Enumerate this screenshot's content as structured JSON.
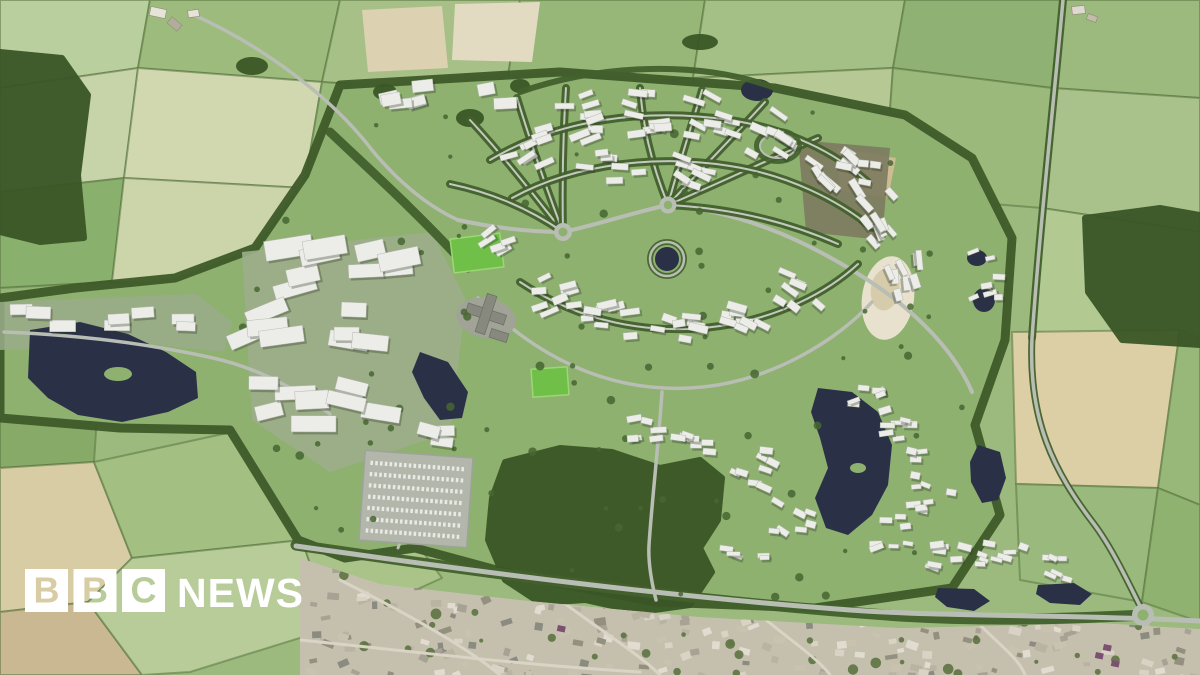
{
  "image": {
    "kind": "news-photo",
    "description": "CGI aerial masterplan visualisation of a proposed new settlement with white model buildings, tree-lined streets, lakes and woodland set among farmland, above an existing town"
  },
  "logo": {
    "blocks": [
      "B",
      "B",
      "C"
    ],
    "wordmark": "NEWS",
    "block_color": "#ffffff",
    "wordmark_color": "#ffffff"
  },
  "colors": {
    "fieldBase": "#9cba7e",
    "hedge": "#5a7440",
    "siteGrass": "#8eb170",
    "siteEdge": "#3d5a28",
    "wood": "#3a5626",
    "treeBelt": "#42602c",
    "water": "#2a3147",
    "road": "#b9beb4",
    "roadMinor": "#c4c9be",
    "building": "#ecede9",
    "buildingStroke": "#b4b7ae",
    "buildingShadow": "rgba(43,53,33,0.32)",
    "pitch": "#6fbf49",
    "townBase": "#c5c0ae",
    "terrace": "#d4e3bc",
    "scatterTree": "#466631"
  },
  "scene": {
    "fields": [
      {
        "pts": "0,0 150,0 138,68 0,88",
        "fill": "#b9cf9e"
      },
      {
        "pts": "150,0 340,0 322,82 138,68",
        "fill": "#9cbb7d"
      },
      {
        "pts": "340,0 520,0 505,95 322,82",
        "fill": "#a6c087"
      },
      {
        "pts": "520,0 705,0 693,78 505,95",
        "fill": "#97b778"
      },
      {
        "pts": "705,0 905,0 893,68 693,78",
        "fill": "#a4c086"
      },
      {
        "pts": "905,0 1062,0 1052,88 893,68",
        "fill": "#8fb173"
      },
      {
        "pts": "1062,0 1200,0 1200,98 1052,88",
        "fill": "#9cba7e"
      },
      {
        "pts": "0,88 138,68 124,178 0,192",
        "fill": "#c7d4a9"
      },
      {
        "pts": "138,68 322,82 304,188 124,178",
        "fill": "#d1d8b0"
      },
      {
        "pts": "0,192 124,178 112,282 0,288",
        "fill": "#8ab06d"
      },
      {
        "pts": "124,178 304,188 292,285 112,282",
        "fill": "#cbd5a9"
      },
      {
        "pts": "322,82 505,95 470,200 304,188",
        "fill": "#9aba7c"
      },
      {
        "pts": "693,78 893,68 884,195 705,188",
        "fill": "#b6c994"
      },
      {
        "pts": "893,68 1052,88 1042,208 884,195",
        "fill": "#9ab97b"
      },
      {
        "pts": "1052,88 1200,98 1200,232 1042,208",
        "fill": "#a9c28b"
      },
      {
        "pts": "1042,208 1200,232 1200,338 1032,332",
        "fill": "#b2c992"
      },
      {
        "pts": "0,288 112,282 102,342 0,345",
        "fill": "#94b577"
      },
      {
        "pts": "0,345 102,342 94,462 0,468",
        "fill": "#88aa69"
      },
      {
        "pts": "0,468 94,462 132,558 88,602 0,612",
        "fill": "#d7cca4"
      },
      {
        "pts": "0,612 88,602 142,675 0,675",
        "fill": "#c9b892"
      },
      {
        "pts": "94,462 232,432 302,540 132,558",
        "fill": "#a3bf82"
      },
      {
        "pts": "132,558 302,540 332,628 190,672 142,675 88,602",
        "fill": "#b7cc99"
      },
      {
        "pts": "1012,332 1180,330 1158,488 1016,484",
        "fill": "#dccfa5"
      },
      {
        "pts": "1180,330 1200,338 1200,505 1158,488",
        "fill": "#98b87a"
      },
      {
        "pts": "1016,484 1158,488 1142,602 1020,580",
        "fill": "#9aba7d"
      },
      {
        "pts": "1158,488 1200,505 1200,622 1142,602",
        "fill": "#8fb271"
      },
      {
        "pts": "302,540 420,548 442,578 332,628",
        "fill": "#aac388"
      },
      {
        "pts": "304,188 470,200 430,260 292,285",
        "fill": "#8fb372"
      }
    ],
    "site": {
      "pts": "340,85 560,72 775,88 905,115 972,158 1012,238 1005,340 975,425 1000,515 952,588 815,608 655,602 515,575 415,548 345,558 298,540 230,430 120,428 0,418 0,298 75,288 175,278 255,248 305,175",
      "fill": "#8eb170",
      "edge": "#3d5a28"
    },
    "platforms": [
      {
        "pts": "242,252 432,232 466,300 450,432 330,472 252,420",
        "fill": "#9dae8b",
        "op": 0.9
      },
      {
        "pts": "0,302 196,294 232,322 224,352 150,344 0,350",
        "fill": "#9aab89",
        "op": 0.85
      },
      {
        "pts": "836,148 896,158 888,198 840,190",
        "fill": "#ccbb93",
        "op": 1
      },
      {
        "pts": "798,140 890,148 882,240 806,232",
        "fill": "#7c7b5f",
        "op": 0.9
      }
    ],
    "terraces": [
      [
        112,
        388,
        14,
        8
      ],
      [
        112,
        388,
        24,
        13
      ],
      [
        112,
        388,
        34,
        18
      ],
      [
        112,
        388,
        44,
        24
      ]
    ],
    "sand_pit": {
      "cx": 888,
      "cy": 298,
      "rx": 26,
      "ry": 42,
      "rot": 8,
      "fill": "#e8e1cd",
      "inner": "#d6cbaa"
    },
    "construction": {
      "pts": "362,10 442,6 448,68 368,72",
      "fill": "#dcd2b2"
    },
    "pale_field": {
      "pts": "455,4 540,2 532,62 452,60",
      "fill": "#e2dbc2"
    },
    "woodlands": [
      {
        "t": "p",
        "pts": "0,52 62,58 88,95 78,175 84,238 40,242 0,232"
      },
      {
        "t": "p",
        "pts": "505,462 560,448 612,452 660,468 700,460 722,478 718,520 700,548 712,572 690,605 640,612 585,600 540,603 505,580 488,540 492,498"
      },
      {
        "t": "p",
        "pts": "1085,218 1160,208 1200,215 1200,345 1122,340 1088,292"
      },
      {
        "t": "e",
        "cx": 252,
        "cy": 66,
        "rx": 16,
        "ry": 9
      },
      {
        "t": "e",
        "cx": 700,
        "cy": 42,
        "rx": 18,
        "ry": 8
      },
      {
        "t": "e",
        "cx": 385,
        "cy": 92,
        "rx": 12,
        "ry": 8
      },
      {
        "t": "e",
        "cx": 470,
        "cy": 118,
        "rx": 14,
        "ry": 9
      },
      {
        "t": "e",
        "cx": 520,
        "cy": 86,
        "rx": 10,
        "ry": 7
      }
    ],
    "streams": [
      {
        "d": "M330,132 C370,170 420,215 468,268",
        "w": 9
      },
      {
        "d": "M1063,0 C1052,120 1040,225 1032,338",
        "w": 8
      },
      {
        "d": "M1032,338 C1028,420 1054,472 1094,524 C1112,548 1128,582 1140,606",
        "w": 7
      },
      {
        "d": "M296,545 C500,575 700,602 900,616 C1000,622 1080,618 1145,615",
        "w": 11
      },
      {
        "d": "M520,92 C600,64 700,60 775,88",
        "w": 6
      }
    ],
    "lakes": [
      {
        "t": "p",
        "pts": "30,330 80,322 128,334 166,352 196,372 198,398 168,412 122,422 78,415 48,398 28,378"
      },
      {
        "t": "e",
        "cx": 118,
        "cy": 374,
        "rx": 14,
        "ry": 7,
        "fill": "#8eb170"
      },
      {
        "t": "p",
        "pts": "420,352 448,362 468,392 462,418 440,420 424,398 412,372"
      },
      {
        "t": "c",
        "cx": 667,
        "cy": 259,
        "r": 12
      },
      {
        "t": "e",
        "cx": 757,
        "cy": 90,
        "rx": 16,
        "ry": 11
      },
      {
        "t": "p",
        "pts": "818,388 852,392 878,412 892,445 888,485 872,515 848,535 826,528 815,498 828,468 820,438 811,412"
      },
      {
        "t": "e",
        "cx": 858,
        "cy": 468,
        "rx": 8,
        "ry": 5,
        "fill": "#8eb170"
      },
      {
        "t": "p",
        "pts": "978,445 1000,452 1006,478 998,500 982,503 971,482 970,462"
      },
      {
        "t": "p",
        "pts": "938,588 974,589 990,601 974,611 947,607 935,597"
      },
      {
        "t": "p",
        "pts": "1038,585 1074,583 1092,594 1080,605 1050,603 1036,594"
      },
      {
        "t": "e",
        "cx": 977,
        "cy": 258,
        "rx": 10,
        "ry": 8
      },
      {
        "t": "e",
        "cx": 984,
        "cy": 300,
        "rx": 11,
        "ry": 12
      }
    ],
    "roads": [
      {
        "d": "M296,546 C480,572 660,596 850,610 C950,617 1060,614 1200,621",
        "w": 5
      },
      {
        "d": "M1143,616 L1170,675",
        "w": 4.5
      },
      {
        "d": "M1063,0 C1052,120 1040,225 1032,338 C1028,420 1054,472 1094,524 C1112,548 1128,582 1140,606",
        "w": 3.5
      },
      {
        "d": "M196,16 C260,45 330,95 372,150 C395,178 425,205 458,220",
        "w": 3.5
      },
      {
        "d": "M458,220 C495,228 530,232 563,232",
        "w": 4
      },
      {
        "d": "M563,232 C600,224 635,212 668,205",
        "w": 4
      },
      {
        "d": "M668,205 C740,212 800,238 855,272 C905,302 952,345 972,392",
        "w": 4
      },
      {
        "d": "M478,298 C540,360 610,392 690,388 C770,384 840,338 872,302",
        "w": 3.5
      },
      {
        "d": "M662,392 C658,450 652,500 649,545 C648,562 651,580 656,600",
        "w": 3.5
      },
      {
        "d": "M440,470 C420,500 406,524 398,548",
        "w": 3
      },
      {
        "d": "M4,332 C80,335 150,344 213,358 C258,368 298,390 330,414",
        "w": 3.5
      }
    ],
    "streets": [
      "M563,232 C530,190 500,152 470,120",
      "M563,232 C545,185 530,140 517,98",
      "M563,232 C562,182 563,135 566,88",
      "M563,232 C525,206 488,192 450,184",
      "M668,205 C650,160 643,125 640,88",
      "M668,205 C680,160 692,125 702,90",
      "M668,205 C705,165 735,135 765,102",
      "M668,205 C722,182 772,158 818,138",
      "M668,205 C730,208 788,222 838,244",
      "M490,160 C560,118 650,108 730,120 C788,129 835,152 868,182",
      "M512,198 C578,162 660,155 730,166 C788,175 838,200 872,228",
      "M520,282 C580,322 650,336 720,326 C778,318 828,292 858,264"
    ],
    "ring_road": {
      "cx": 667,
      "cy": 259,
      "r": 17
    },
    "oval_park": {
      "cx": 778,
      "cy": 146,
      "rx": 18,
      "ry": 12
    },
    "roundabouts": [
      [
        563,
        232,
        9
      ],
      [
        668,
        205,
        8.5
      ],
      [
        1143,
        615,
        11
      ]
    ],
    "pitches": [
      [
        452,
        236,
        50,
        34,
        -7
      ],
      [
        532,
        368,
        36,
        28,
        -4
      ]
    ],
    "campus": {
      "pad": {
        "cx": 486,
        "cy": 318,
        "rx": 30,
        "ry": 20,
        "rot": 10,
        "fill": "#a0a396"
      },
      "rot": "rotate(18 486 314)",
      "rects": [
        [
          466,
          309,
          40,
          10
        ],
        [
          481,
          294,
          10,
          40
        ],
        [
          496,
          326,
          18,
          9
        ]
      ],
      "fill": "#87897f"
    },
    "parking": {
      "x": 362,
      "y": 454,
      "w": 108,
      "h": 90,
      "rot": "rotate(4 416 499)",
      "fill": "#b2b6ab",
      "rows": 7,
      "rowX1": 368,
      "rowX2": 462,
      "rowY": 466,
      "rowStep": 11.3,
      "rowColor": "#e9eae3"
    },
    "farms": [
      [
        150,
        8,
        16,
        9,
        12,
        "#e6e3d8"
      ],
      [
        168,
        20,
        13,
        8,
        40,
        "#b3ac9a"
      ],
      [
        188,
        10,
        11,
        7,
        -8,
        "#e6e3d8"
      ],
      [
        1072,
        6,
        13,
        8,
        -6,
        "#ddd9cc"
      ],
      [
        1087,
        15,
        10,
        6,
        20,
        "#c2bcab"
      ]
    ],
    "clusters": [
      [
        520,
        140,
        26,
        24,
        9,
        -28,
        14,
        13,
        22,
        5,
        8
      ],
      [
        585,
        118,
        22,
        26,
        9,
        -10,
        14,
        13,
        22,
        5,
        8
      ],
      [
        648,
        112,
        20,
        26,
        9,
        5,
        14,
        13,
        22,
        5,
        8
      ],
      [
        712,
        118,
        22,
        24,
        9,
        18,
        14,
        13,
        22,
        5,
        8
      ],
      [
        775,
        135,
        24,
        22,
        9,
        30,
        14,
        13,
        22,
        5,
        8
      ],
      [
        832,
        168,
        26,
        22,
        9,
        45,
        14,
        13,
        22,
        5,
        8
      ],
      [
        872,
        218,
        24,
        24,
        9,
        60,
        14,
        13,
        22,
        5,
        8
      ],
      [
        898,
        272,
        22,
        24,
        8,
        72,
        14,
        12,
        20,
        5,
        8
      ],
      [
        612,
        168,
        30,
        16,
        7,
        0,
        16,
        12,
        20,
        5,
        7
      ],
      [
        700,
        172,
        28,
        16,
        7,
        20,
        16,
        12,
        20,
        5,
        7
      ],
      [
        548,
        296,
        26,
        20,
        8,
        -15,
        15,
        12,
        20,
        5,
        8
      ],
      [
        612,
        322,
        26,
        18,
        8,
        -5,
        15,
        12,
        20,
        5,
        8
      ],
      [
        676,
        334,
        26,
        18,
        8,
        5,
        15,
        12,
        20,
        5,
        8
      ],
      [
        742,
        318,
        26,
        18,
        8,
        18,
        15,
        12,
        20,
        5,
        8
      ],
      [
        800,
        290,
        22,
        18,
        7,
        30,
        15,
        12,
        20,
        5,
        8
      ],
      [
        492,
        238,
        20,
        16,
        5,
        -30,
        15,
        11,
        18,
        5,
        7
      ],
      [
        982,
        278,
        18,
        30,
        8,
        -8,
        18,
        8,
        14,
        4,
        6
      ],
      [
        862,
        172,
        20,
        14,
        4,
        10,
        12,
        10,
        16,
        5,
        7
      ],
      [
        312,
        262,
        40,
        26,
        5,
        -12,
        10,
        28,
        50,
        13,
        20
      ],
      [
        395,
        258,
        34,
        22,
        4,
        -5,
        10,
        26,
        44,
        12,
        18
      ],
      [
        282,
        322,
        34,
        20,
        4,
        -15,
        10,
        26,
        46,
        12,
        18
      ],
      [
        362,
        322,
        30,
        20,
        4,
        0,
        10,
        24,
        40,
        12,
        17
      ],
      [
        278,
        408,
        36,
        26,
        5,
        -8,
        10,
        26,
        48,
        12,
        19
      ],
      [
        368,
        398,
        32,
        24,
        4,
        5,
        10,
        24,
        42,
        12,
        17
      ],
      [
        424,
        434,
        20,
        16,
        3,
        8,
        10,
        20,
        32,
        10,
        14
      ],
      [
        38,
        318,
        28,
        10,
        3,
        2,
        6,
        22,
        32,
        10,
        13
      ],
      [
        118,
        316,
        26,
        10,
        3,
        -4,
        6,
        20,
        30,
        10,
        13
      ],
      [
        186,
        322,
        16,
        9,
        2,
        5,
        6,
        18,
        26,
        9,
        12
      ],
      [
        700,
        440,
        24,
        18,
        7,
        10,
        16,
        10,
        16,
        5,
        7
      ],
      [
        755,
        470,
        24,
        20,
        8,
        15,
        16,
        10,
        16,
        5,
        7
      ],
      [
        795,
        520,
        22,
        20,
        7,
        20,
        16,
        10,
        16,
        5,
        7
      ],
      [
        745,
        556,
        20,
        12,
        5,
        12,
        16,
        9,
        15,
        4,
        6
      ],
      [
        638,
        428,
        22,
        12,
        6,
        0,
        16,
        10,
        16,
        5,
        7
      ],
      [
        868,
        392,
        22,
        20,
        8,
        -10,
        16,
        9,
        15,
        4,
        7
      ],
      [
        908,
        440,
        24,
        22,
        9,
        0,
        16,
        9,
        15,
        4,
        7
      ],
      [
        934,
        492,
        22,
        20,
        8,
        5,
        16,
        9,
        15,
        4,
        7
      ],
      [
        892,
        532,
        20,
        16,
        7,
        -5,
        16,
        9,
        15,
        4,
        7
      ],
      [
        946,
        556,
        22,
        14,
        7,
        8,
        16,
        9,
        15,
        4,
        7
      ],
      [
        1002,
        556,
        24,
        14,
        8,
        10,
        16,
        9,
        15,
        4,
        7
      ],
      [
        1050,
        568,
        18,
        11,
        6,
        12,
        16,
        8,
        14,
        4,
        6
      ],
      [
        445,
        100,
        62,
        16,
        8,
        -10,
        8,
        15,
        25,
        9,
        13
      ]
    ],
    "site_trees": {
      "n": 95,
      "x": 240,
      "y": 85,
      "w": 770,
      "h": 515
    },
    "town": {
      "clip": "300,558 380,584 520,600 700,617 900,628 1100,623 1200,629 1200,675 300,675",
      "base": "#c5c0ae",
      "n": 300,
      "palette": [
        "#b9b3a2",
        "#d8d3c4",
        "#a7a294",
        "#c8c2af",
        "#e0dcd0",
        "#94907f",
        "#8b8b82"
      ],
      "trees": 55,
      "treeFill": "#5d7343",
      "roads": [
        "M340,580 C420,620 470,650 500,675",
        "M560,600 C600,630 640,655 660,675",
        "M760,615 C790,640 820,660 830,675",
        "M980,625 C1000,645 1020,660 1025,675",
        "M300,640 C400,650 520,665 640,672"
      ],
      "roadColor": "#d9d4c6",
      "accents": [
        [
          1096,
          652
        ],
        [
          1112,
          660
        ],
        [
          1104,
          644
        ],
        [
          558,
          625
        ]
      ],
      "accentFill": "#7b5070"
    }
  }
}
